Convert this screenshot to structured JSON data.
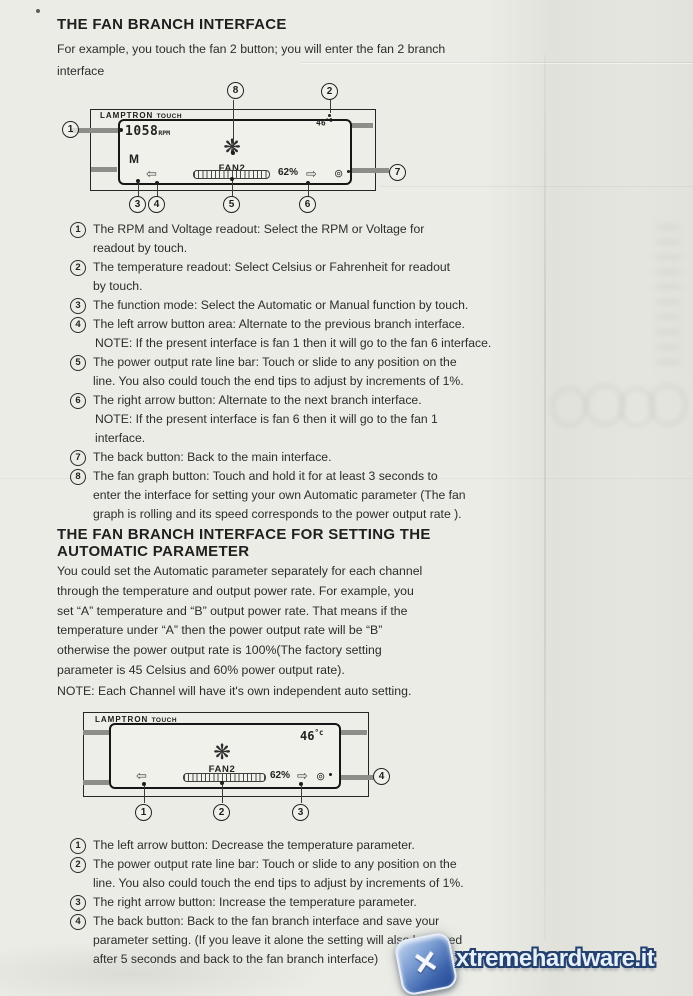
{
  "section1": {
    "title": "THE FAN BRANCH INTERFACE",
    "intro": "For example, you touch the fan 2 button; you will enter the fan 2 branch\ninterface",
    "items": [
      {
        "num": "1",
        "text": "The RPM and Voltage readout: Select the RPM or Voltage for\nreadout by touch."
      },
      {
        "num": "2",
        "text": "The temperature readout: Select Celsius or Fahrenheit for readout\nby touch."
      },
      {
        "num": "3",
        "text": "The function mode: Select the Automatic or Manual function by touch."
      },
      {
        "num": "4",
        "text": "The left arrow button area: Alternate to the previous branch interface.",
        "note": "NOTE: If the present interface is fan 1 then it will go to the fan 6 interface."
      },
      {
        "num": "5",
        "text": "The power output rate line bar: Touch or slide to any position on the\nline. You also could touch the end tips to adjust by increments of 1%."
      },
      {
        "num": "6",
        "text": "The right arrow button: Alternate to the next branch interface.",
        "note": "NOTE: If the present interface is fan 6 then it will go to the fan 1\ninterface."
      },
      {
        "num": "7",
        "text": "The back button: Back to the main interface."
      },
      {
        "num": "8",
        "text": "The fan graph button: Touch and hold it for at least 3 seconds to\nenter the interface for setting your own Automatic parameter (The fan\ngraph is rolling and its speed corresponds to the power output rate )."
      }
    ]
  },
  "section2": {
    "title": "THE FAN BRANCH INTERFACE FOR SETTING THE\nAUTOMATIC PARAMETER",
    "paragraph": "You could set the Automatic parameter separately for each channel\nthrough the temperature and output power rate. For example, you\nset “A” temperature and “B” output power rate. That means if the\ntemperature under “A” then the power output rate will be “B”\notherwise the power output rate is 100%(The factory setting\nparameter is 45 Celsius and 60% power output rate).",
    "note": "NOTE: Each Channel will have it's own independent auto setting.",
    "items": [
      {
        "num": "1",
        "text": "The left arrow button: Decrease the temperature parameter."
      },
      {
        "num": "2",
        "text": "The power output rate line bar: Touch or slide to any position on the\nline. You also could touch the end tips to adjust by increments of 1%."
      },
      {
        "num": "3",
        "text": "The right arrow button: Increase the temperature parameter."
      },
      {
        "num": "4",
        "text": "The back button: Back to the fan branch interface and save your\nparameter setting. (If you leave it alone the setting will also be saved\nafter 5 seconds and back to the fan branch interface)"
      }
    ]
  },
  "diagram1": {
    "brand": "LAMPTRON",
    "brand_sub": "TOUCH",
    "rpm_value": "1058",
    "rpm_unit": "RPM",
    "temp_value": "46",
    "temp_unit": "°C",
    "mode": "M",
    "fan_label": "FAN2",
    "percent": "62%",
    "callouts": [
      "1",
      "2",
      "3",
      "4",
      "5",
      "6",
      "7",
      "8"
    ]
  },
  "diagram2": {
    "brand": "LAMPTRON",
    "brand_sub": "TOUCH",
    "temp_value": "46",
    "temp_unit": "°c",
    "fan_label": "FAN2",
    "percent": "62%",
    "callouts": [
      "1",
      "2",
      "3",
      "4"
    ]
  },
  "icons": {
    "left_arrow": "⇦",
    "right_arrow": "⇨",
    "fan": "❋",
    "back": "⊚"
  },
  "watermark": {
    "site": "xtremehardware.it",
    "logo_glyph": "✕"
  },
  "colors": {
    "logo_blue": "#3b62ab",
    "outline_navy": "#24406e"
  }
}
